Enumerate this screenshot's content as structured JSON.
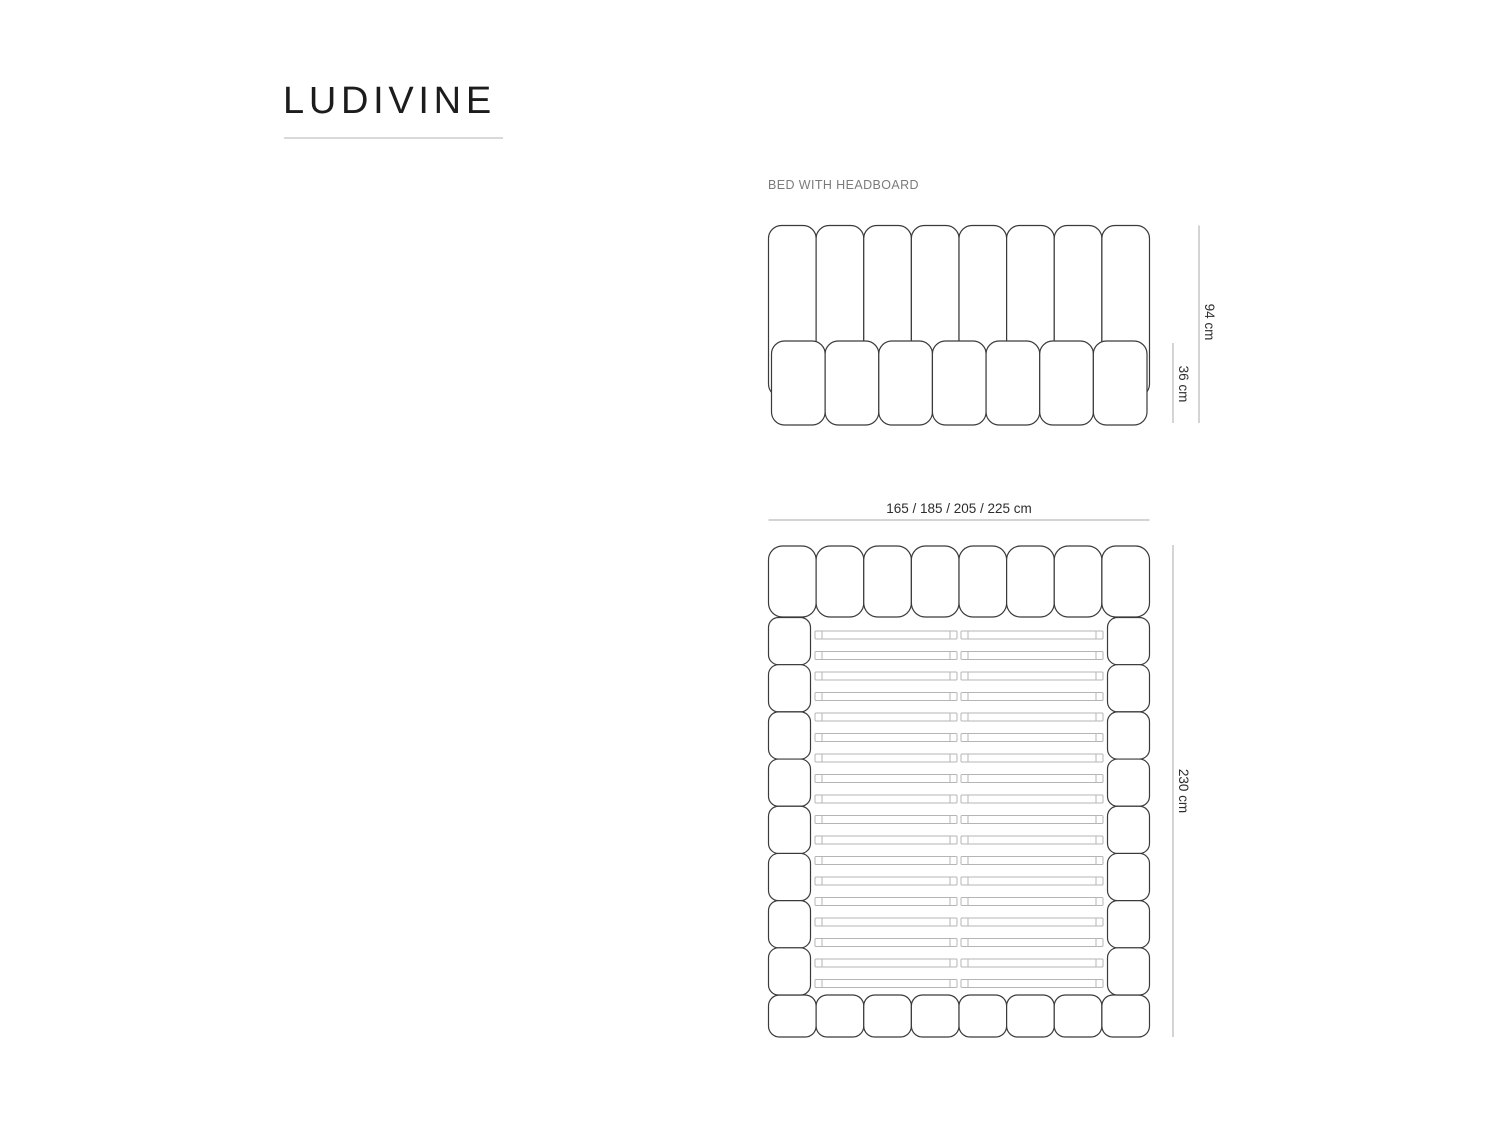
{
  "page_title": "LUDIVINE",
  "front_view": {
    "label": "BED WITH HEADBOARD",
    "total_height": "94 cm",
    "base_height": "36 cm",
    "headboard_channels": 8,
    "base_cushions": 7
  },
  "top_view": {
    "width_options": "165 / 185 / 205 / 225 cm",
    "length": "230 cm",
    "headboard_panels": 8,
    "footboard_panels": 8,
    "side_rail_segments": 8,
    "slat_rows": 18
  },
  "colors": {
    "title_text": "#1c1c1c",
    "underline": "#d9d9d9",
    "label_text": "#7b7b7b",
    "outline": "#3a3a3a",
    "slat": "#b5b5b5",
    "dimension_line": "#a8a8a8",
    "dimension_text": "#2d2d2d"
  }
}
